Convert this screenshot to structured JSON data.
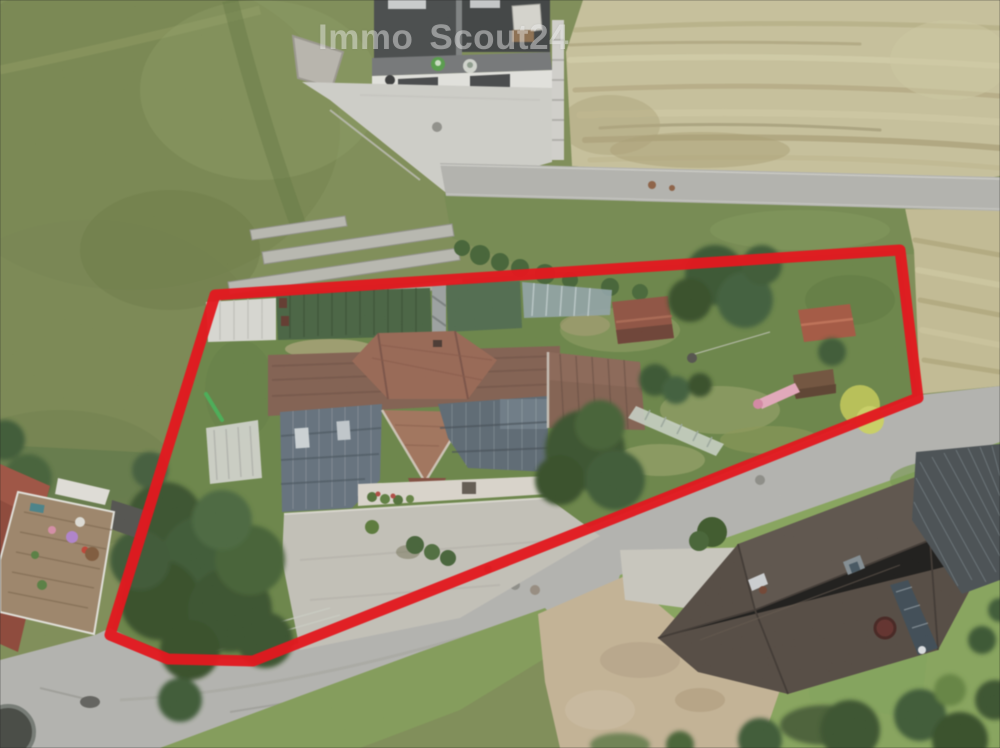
{
  "watermark": {
    "full": "ImmoScout24",
    "part1": "Immo",
    "part2": "Scout24"
  },
  "boundary": {
    "points": "215,295 900,250 918,398 253,661 168,659 110,635",
    "color": "#e2191f"
  },
  "palette": {
    "boundary_red": "#e2191f",
    "meadow_green": "#7a8a4f",
    "hay_field": "#c9c29a",
    "asphalt_grey": "#b4b4b0",
    "concrete_grey": "#d2d1cc",
    "farmhouse_roof_brown": "#7d5848",
    "solar_panel_blue": "#5d6b79",
    "barn_roof_green": "#3e5c38",
    "dark_house_roof": "#4b4038",
    "dirt_path_tan": "#c6b394",
    "tree_dark_green": "#2e4a24"
  }
}
